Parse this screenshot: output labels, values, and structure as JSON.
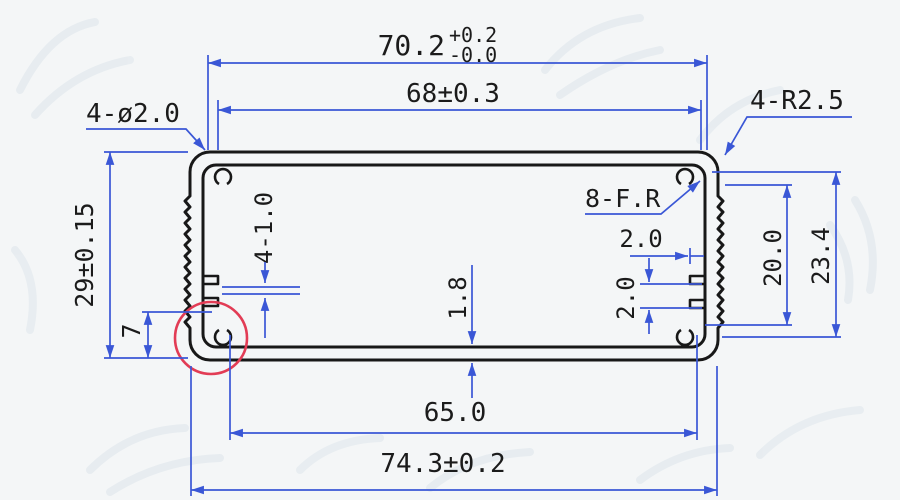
{
  "drawing": {
    "type": "engineering-cross-section",
    "subject": "aluminum extrusion enclosure profile"
  },
  "colors": {
    "background": "#f4f6f7",
    "dimension": "#3a57d6",
    "profile": "#181818",
    "highlight": "#e23c55",
    "text": "#1b1b1b",
    "watermark": "#e2e9ee"
  },
  "labels": {
    "top_width": {
      "value": "70.2",
      "tol_upper": "+0.2",
      "tol_lower": "-0.0"
    },
    "top_inner_width": "68±0.3",
    "holes": "4-ø2.0",
    "corner_radius": "4-R2.5",
    "fillet": "8-F.R",
    "left_height": "29±0.15",
    "left_corner_height": "7",
    "rib_slots": "4-1.0",
    "bottom_wall": "1.8",
    "slot_depth": "2.0",
    "slot_pitch": "2.0",
    "right_inner_height": "20.0",
    "right_feature_height": "23.4",
    "bottom_inner_width": "65.0",
    "bottom_width": "74.3±0.2"
  }
}
